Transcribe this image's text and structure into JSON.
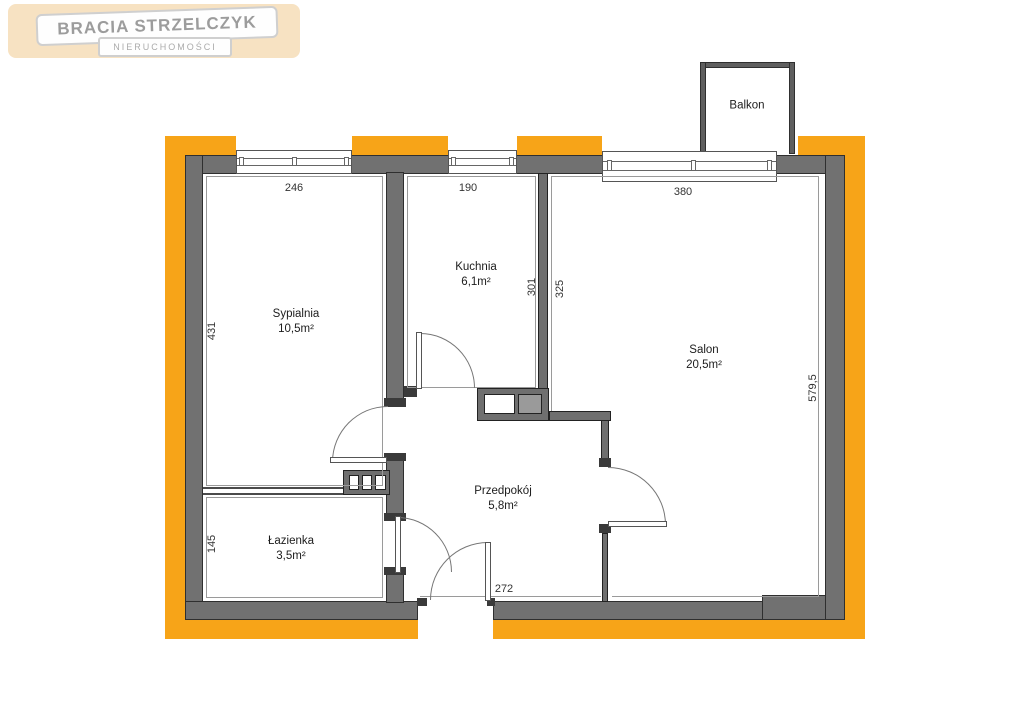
{
  "logo": {
    "title": "BRACIA STRZELCZYK",
    "subtitle": "NIERUCHOMOŚCI"
  },
  "rooms": {
    "sypialnia": {
      "name": "Sypialnia",
      "area": "10,5m²"
    },
    "kuchnia": {
      "name": "Kuchnia",
      "area": "6,1m²"
    },
    "salon": {
      "name": "Salon",
      "area": "20,5m²"
    },
    "przedpokoj": {
      "name": "Przedpokój",
      "area": "5,8m²"
    },
    "lazienka": {
      "name": "Łazienka",
      "area": "3,5m²"
    },
    "balkon": {
      "name": "Balkon"
    }
  },
  "dims": {
    "bedroom_window": "246",
    "kitchen_window": "190",
    "salon_window": "380",
    "bedroom_left_wall": "431",
    "bathroom_left_wall": "145",
    "kitchen_right_wall": "301",
    "salon_left_wall": "325",
    "salon_right_wall": "579,5",
    "entry_bottom_wall": "272"
  },
  "colors": {
    "accent_orange": "#F7A418",
    "wall_gray": "#717171"
  }
}
